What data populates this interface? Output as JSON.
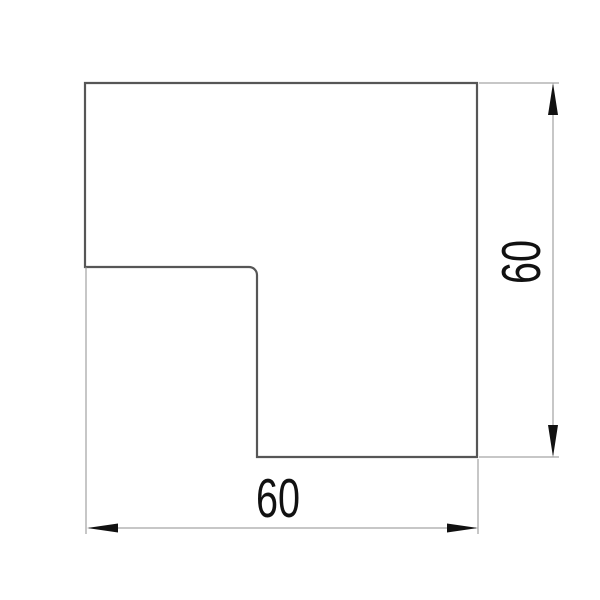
{
  "drawing": {
    "shape": "l-shaped-flat-angle",
    "horizontal_dimension_label": "60",
    "vertical_dimension_label": "60",
    "colors": {
      "background": "#ffffff",
      "outline": "#565656",
      "dimension_lines": "#8f8f8f",
      "annotation": "#111111"
    }
  }
}
